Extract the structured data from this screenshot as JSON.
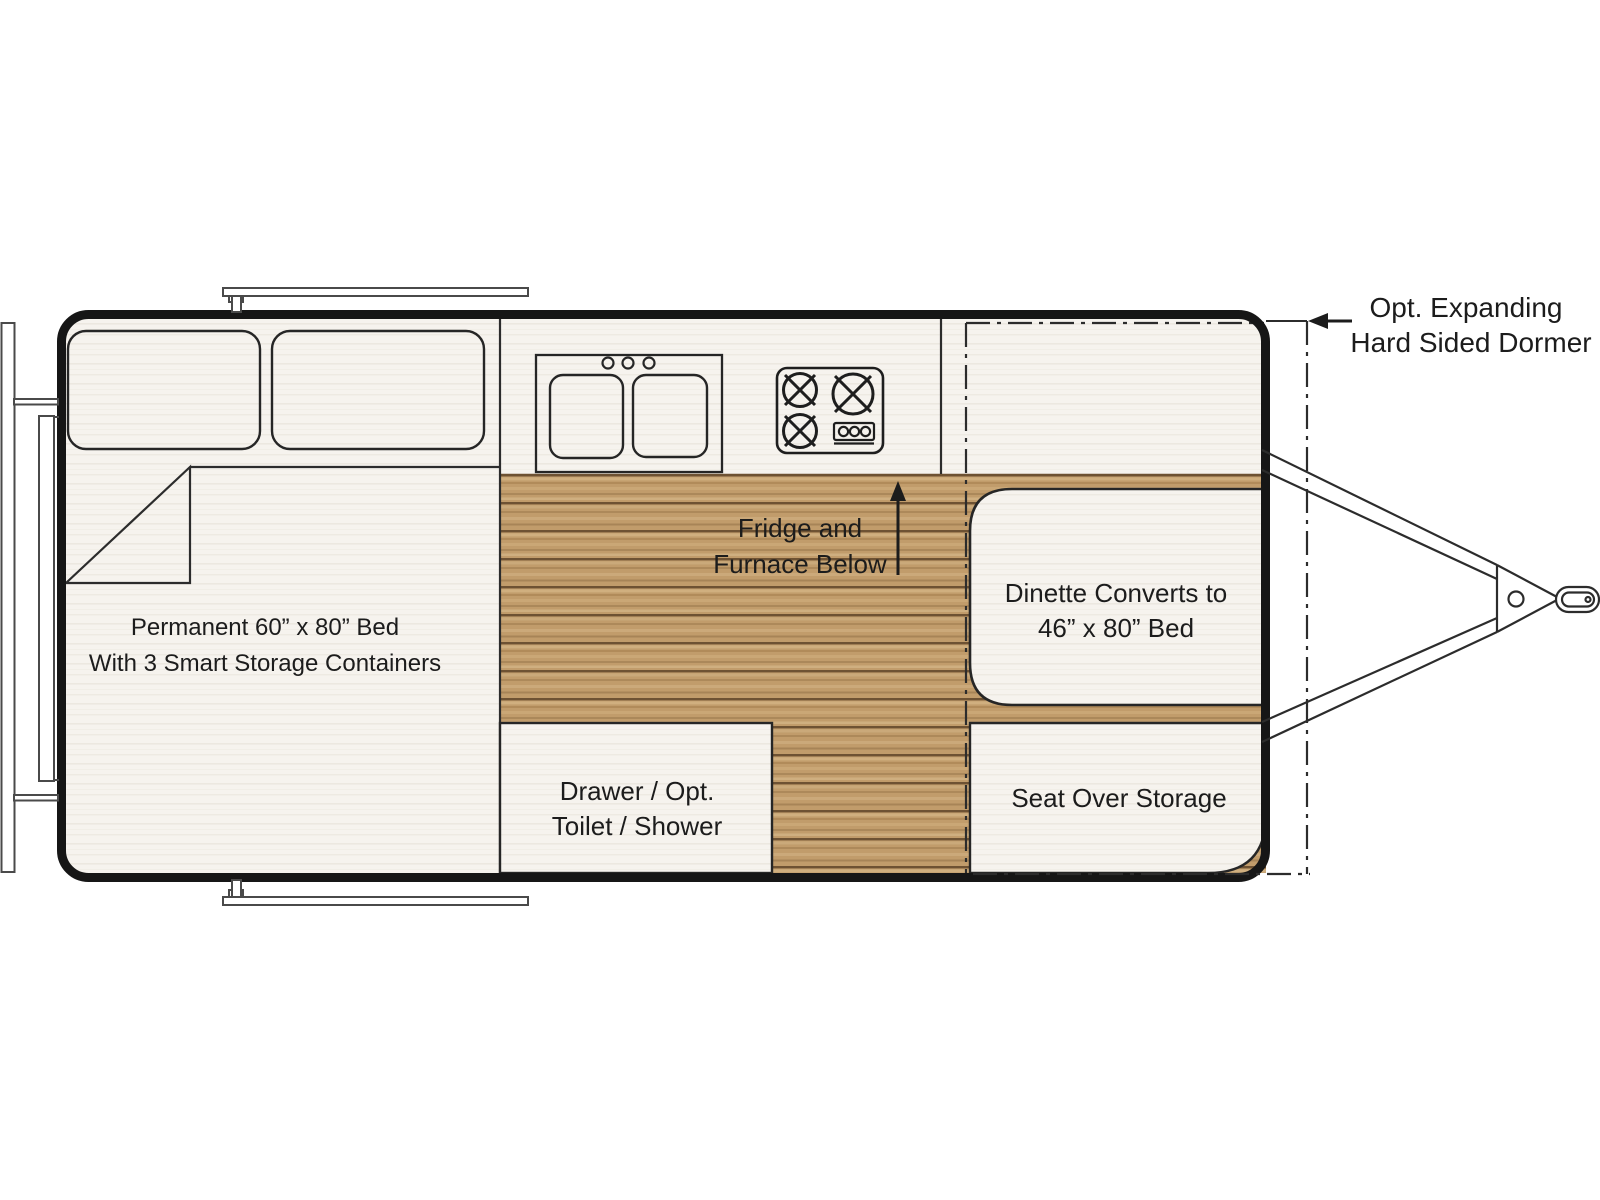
{
  "title": "Travel trailer floor plan",
  "labels": {
    "bed": {
      "l1": "Permanent 60” x 80” Bed",
      "l2": "With 3 Smart Storage Containers"
    },
    "fridge": {
      "l1": "Fridge and",
      "l2": "Furnace Below"
    },
    "drawer": {
      "l1": "Drawer / Opt.",
      "l2": "Toilet / Shower"
    },
    "dinette": {
      "l1": "Dinette Converts to",
      "l2": "46” x 80” Bed"
    },
    "seat": {
      "l1": "Seat Over Storage"
    },
    "dormer": {
      "l1": "Opt. Expanding",
      "l2": "Hard Sided Dormer"
    }
  },
  "colors": {
    "wall": "#161616",
    "line": "#2c2c2c",
    "interior": "#f6f3ee",
    "wood": "#c19c6b",
    "wood_seam": "#6e5233",
    "text": "#1c1c1c",
    "background": "#ffffff"
  }
}
